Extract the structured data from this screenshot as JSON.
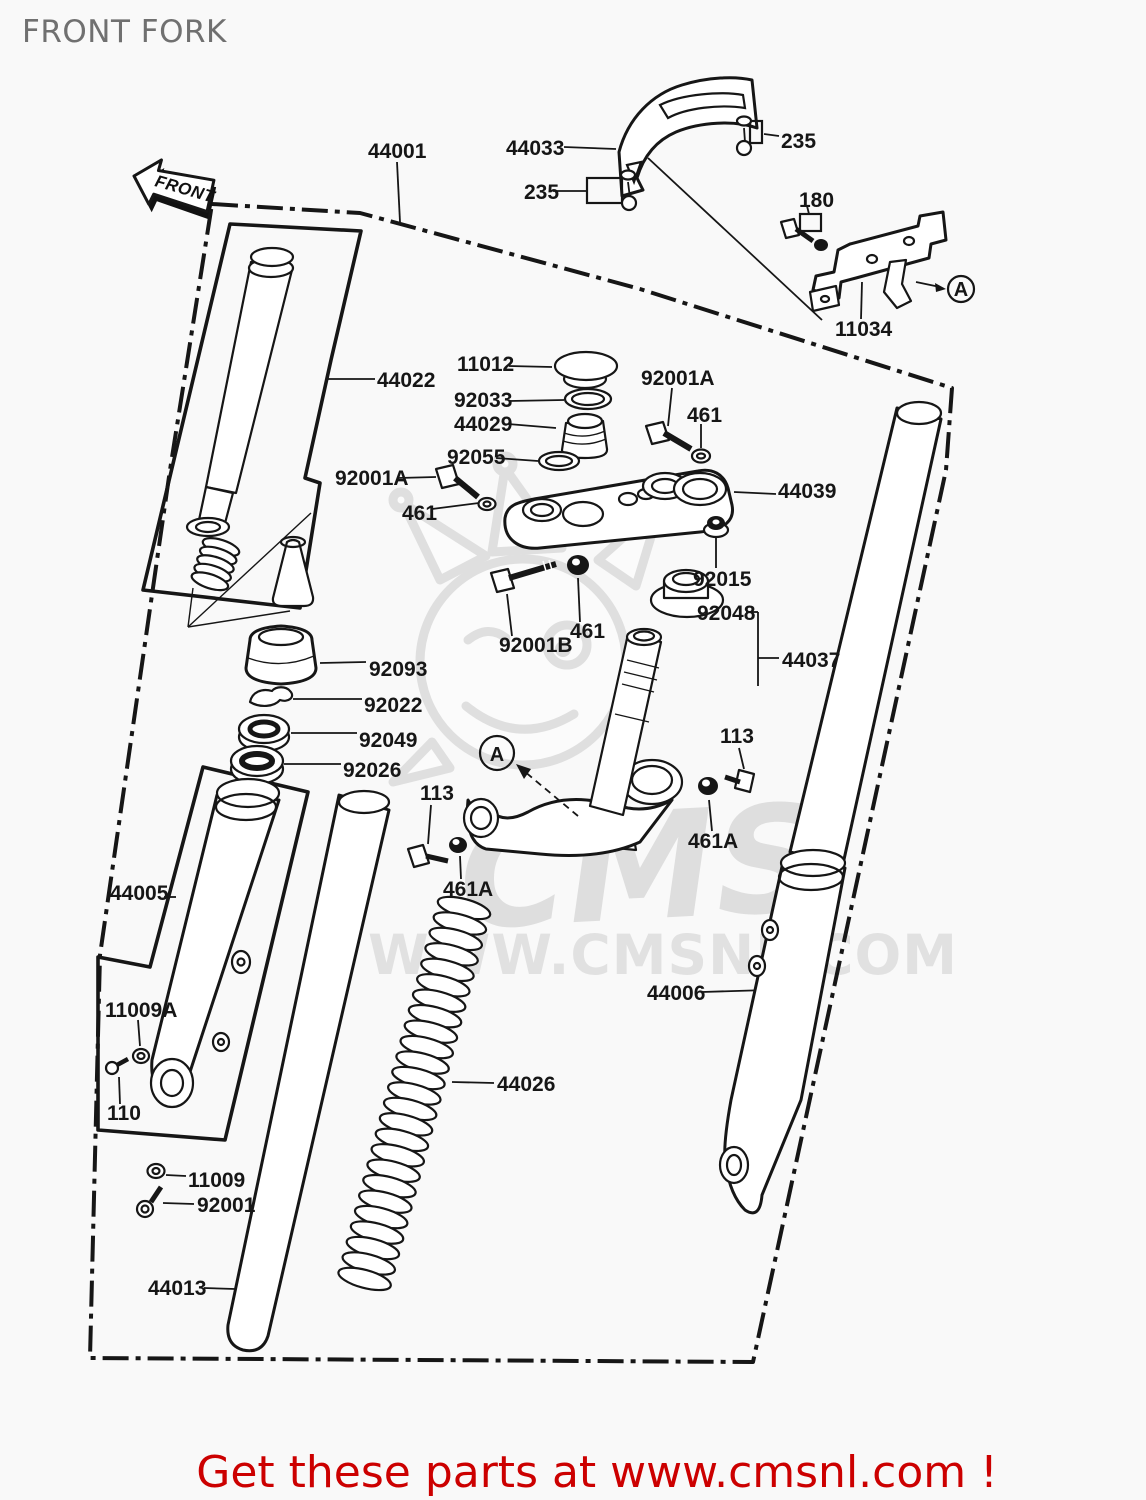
{
  "page": {
    "title": "FRONT FORK"
  },
  "direction_arrow": {
    "label": "FRONT"
  },
  "watermark": {
    "logo_text": "CMS",
    "site_text": "WWW.CMSNL.COM",
    "color": "#dcdcdc"
  },
  "footer": {
    "text": "Get these parts at www.cmsnl.com !",
    "color": "#cc0000"
  },
  "detail_markers": {
    "top": "A",
    "bottom": "A"
  },
  "part_labels": {
    "l44001": "44001",
    "l44033": "44033",
    "l235_left": "235",
    "l235_right": "235",
    "l180": "180",
    "l11034": "11034",
    "l11012": "11012",
    "l92033": "92033",
    "l44029": "44029",
    "l92055": "92055",
    "l92001a_top": "92001A",
    "l461_top": "461",
    "l44039": "44039",
    "l92015": "92015",
    "l92048": "92048",
    "l44037": "44037",
    "l92001b": "92001B",
    "l461_mid": "461",
    "l92001a_left": "92001A",
    "l461_left": "461",
    "l44022": "44022",
    "l92093": "92093",
    "l92022": "92022",
    "l92049": "92049",
    "l92026": "92026",
    "l113_left": "113",
    "l461a_left": "461A",
    "l113_right": "113",
    "l461a_right": "461A",
    "l44005": "44005",
    "l11009a": "11009A",
    "l110": "110",
    "l11009": "11009",
    "l92001": "92001",
    "l44013": "44013",
    "l44006": "44006",
    "l44026": "44026"
  }
}
